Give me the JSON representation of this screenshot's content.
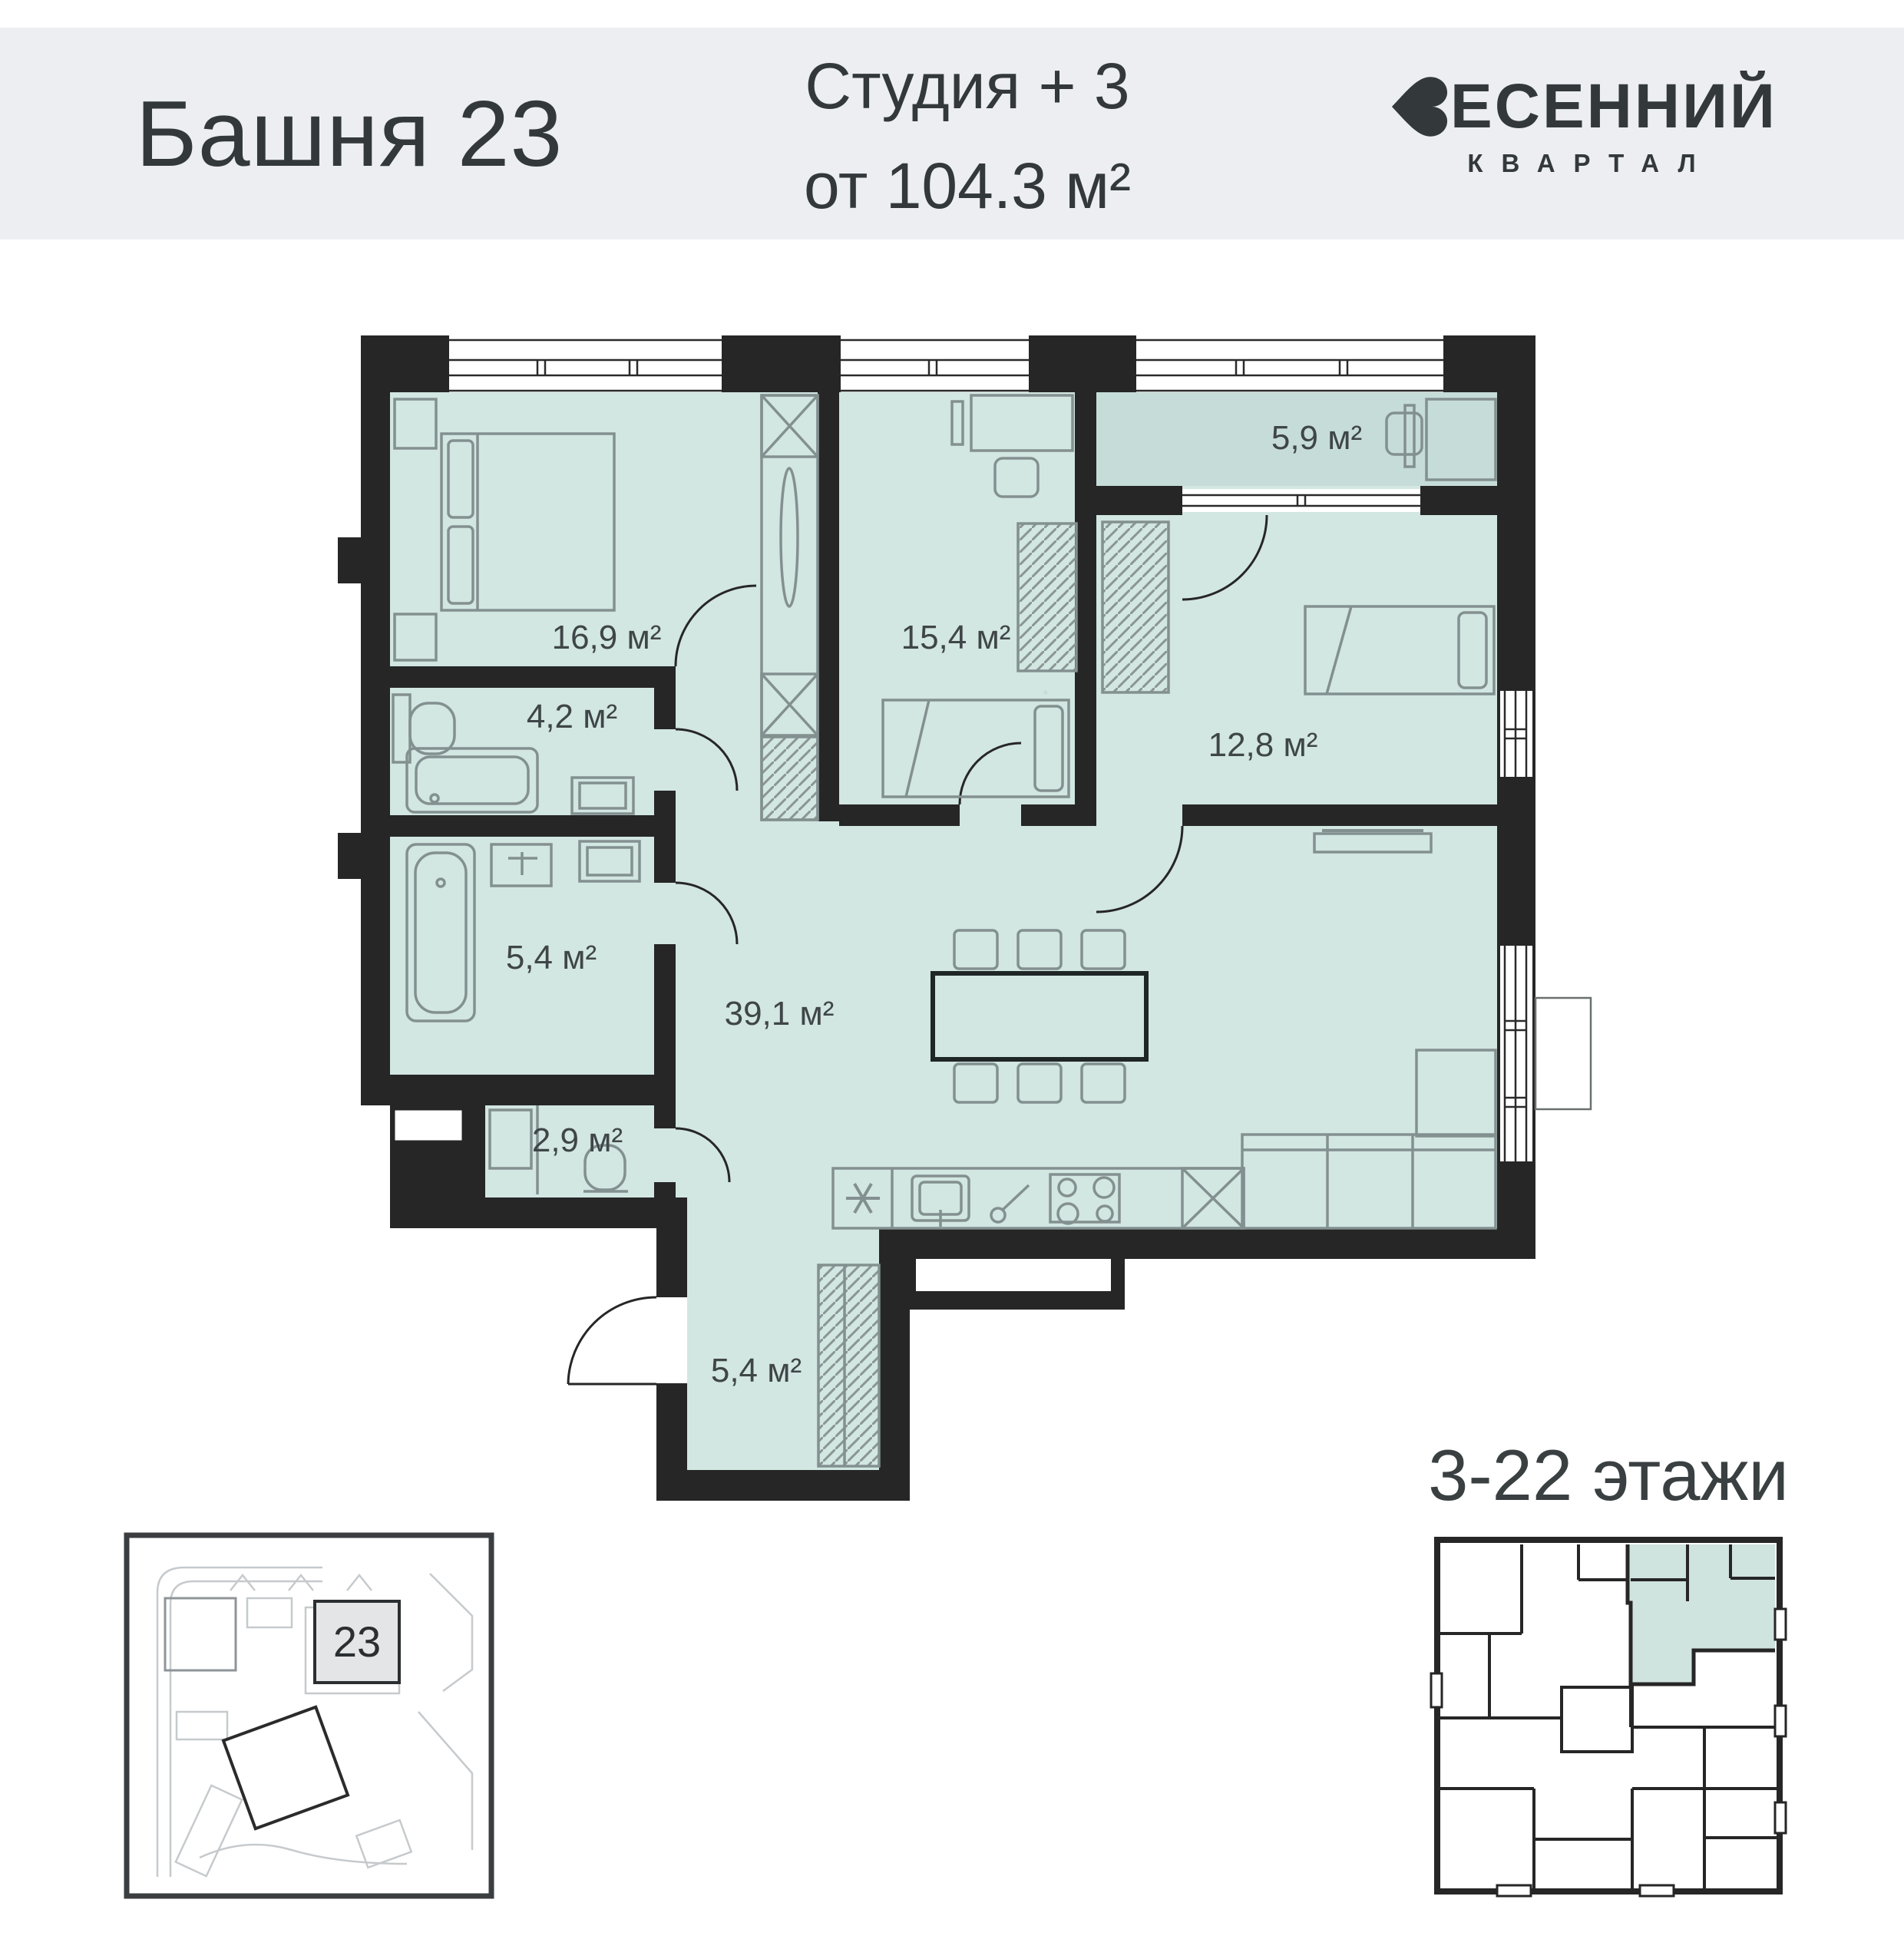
{
  "header": {
    "tower_label": "Башня 23",
    "unit_type": "Студия + 3",
    "area_from": "от 104.3 м²",
    "brand_rest": "ЕСЕННИЙ",
    "brand_sub": "КВАРТАЛ",
    "band_color": "#eceef1"
  },
  "floor_plan": {
    "wall_color": "#262626",
    "room_fill": "#d2e6e2",
    "balcony_fill": "#c6dcd8",
    "furniture_stroke": "#839090",
    "label_color": "#3f4647",
    "rooms": [
      {
        "id": "bedroom-1",
        "area_label": "16,9 м²"
      },
      {
        "id": "bathroom-1",
        "area_label": "4,2 м²"
      },
      {
        "id": "bedroom-2",
        "area_label": "15,4 м²"
      },
      {
        "id": "balcony",
        "area_label": "5,9 м²"
      },
      {
        "id": "bedroom-3",
        "area_label": "12,8 м²"
      },
      {
        "id": "bathroom-2",
        "area_label": "5,4 м²"
      },
      {
        "id": "living-kitchen",
        "area_label": "39,1 м²"
      },
      {
        "id": "wc",
        "area_label": "2,9 м²"
      },
      {
        "id": "hallway",
        "area_label": "5,4 м²"
      }
    ]
  },
  "site_plan": {
    "building_number": "23"
  },
  "floors_badge": {
    "label": "3-22 этажи",
    "highlight_fill": "#cfe3df"
  }
}
